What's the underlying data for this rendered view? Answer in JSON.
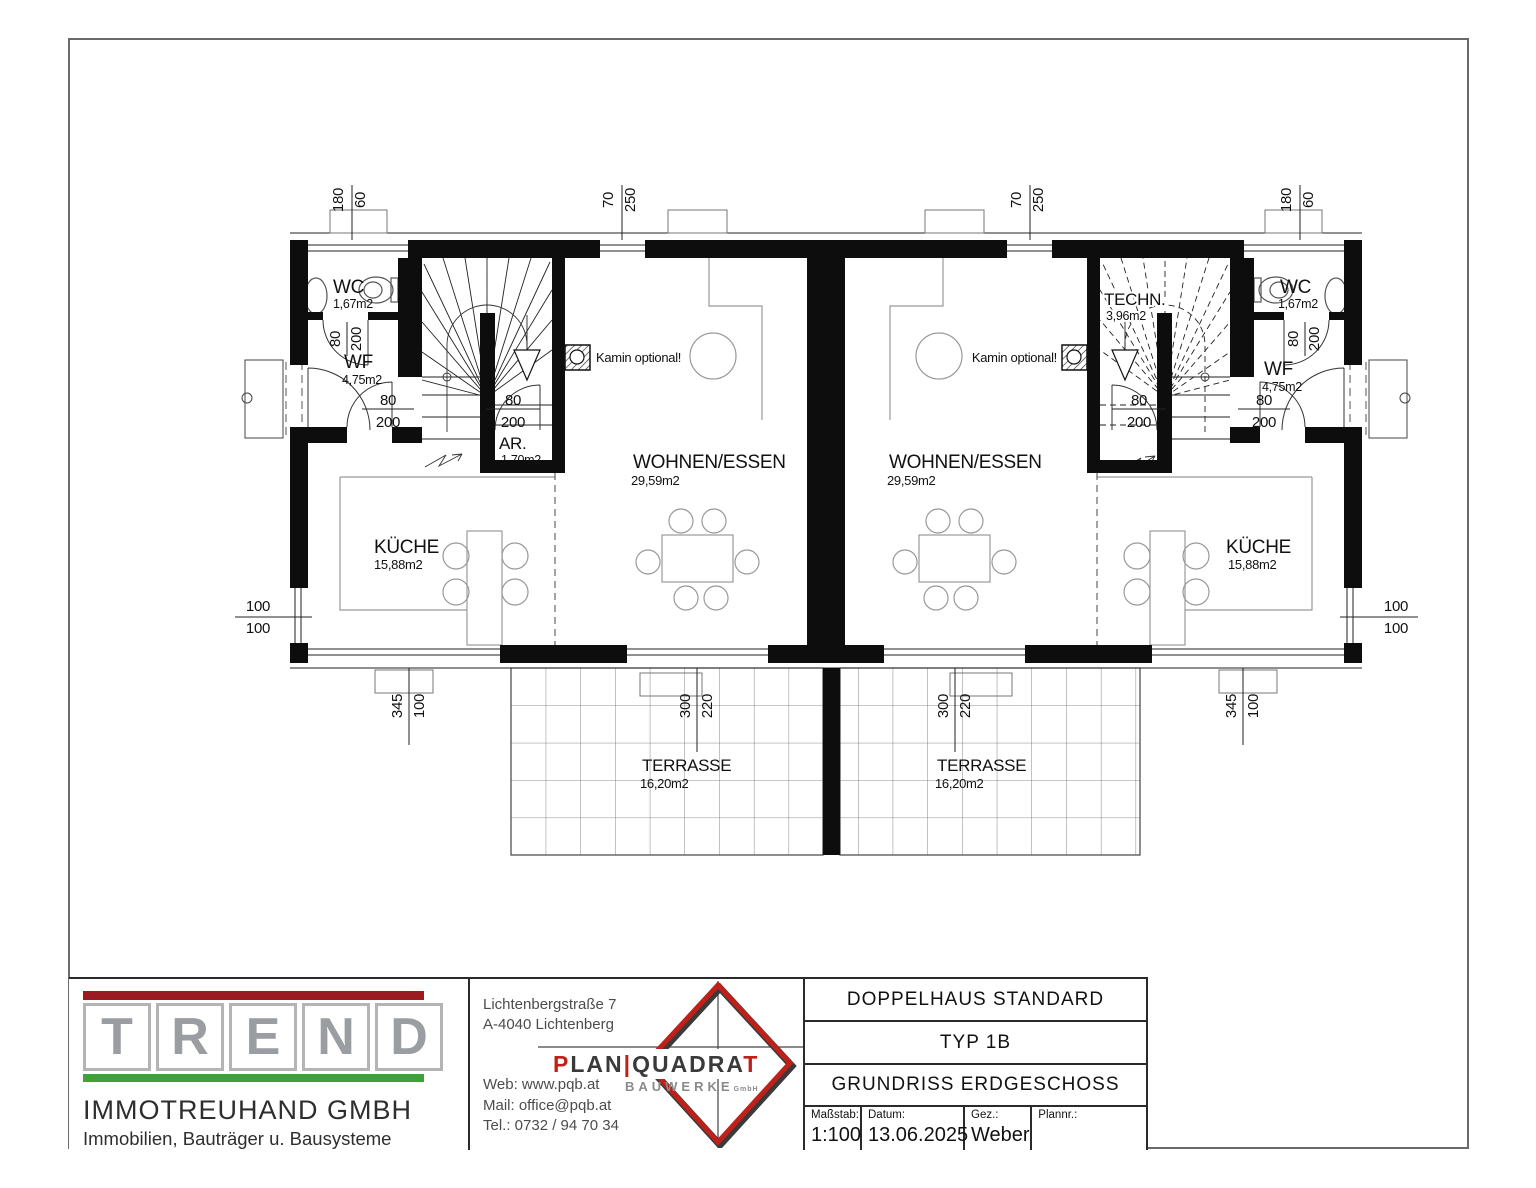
{
  "plan": {
    "rooms": {
      "wc": {
        "name": "WC",
        "area": "1,67m2"
      },
      "wf": {
        "name": "WF",
        "area": "4,75m2"
      },
      "ar": {
        "name": "AR.",
        "area": "1,70m2"
      },
      "techn": {
        "name": "TECHN.",
        "area": "3,96m2"
      },
      "wohnen": {
        "name": "WOHNEN/ESSEN",
        "area": "29,59m2"
      },
      "kueche": {
        "name": "KÜCHE",
        "area": "15,88m2"
      },
      "terrasse": {
        "name": "TERRASSE",
        "area": "16,20m2"
      }
    },
    "annotations": {
      "kamin": "Kamin optional!"
    },
    "dims": {
      "top_outer": [
        "180",
        "60"
      ],
      "top_inner": [
        "70",
        "250"
      ],
      "side": [
        "100",
        "100"
      ],
      "win_b": [
        "345",
        "100"
      ],
      "door_b": [
        "300",
        "220"
      ],
      "door": [
        "80",
        "200"
      ]
    }
  },
  "title_block": {
    "trend": {
      "letters": [
        "T",
        "R",
        "E",
        "N",
        "D"
      ],
      "company": "IMMOTREUHAND GMBH",
      "tagline": "Immobilien, Bauträger u. Bausysteme",
      "bar_red": "#9c1b20",
      "bar_green": "#3da238"
    },
    "architect": {
      "address_line1": "Lichtenbergstraße 7",
      "address_line2": "A-4040 Lichtenberg",
      "web": "Web: www.pqb.at",
      "mail": "Mail: office@pqb.at",
      "tel": "Tel.: 0732 / 94 70 34",
      "logo_plan": "PLAN",
      "logo_sep": "|",
      "logo_quadrat": "QUADRA",
      "logo_t": "T",
      "logo_sub": "BAUWERKE",
      "logo_sub2": "GmbH",
      "logo_red": "#c0201a"
    },
    "project": {
      "line1": "DOPPELHAUS STANDARD",
      "line2": "TYP 1B",
      "line3": "GRUNDRISS ERDGESCHOSS",
      "fields": [
        {
          "label": "Maßstab:",
          "value": "1:100"
        },
        {
          "label": "Datum:",
          "value": "13.06.2025"
        },
        {
          "label": "Gez.:",
          "value": "Weber"
        },
        {
          "label": "Plannr.:",
          "value": ""
        }
      ]
    }
  }
}
